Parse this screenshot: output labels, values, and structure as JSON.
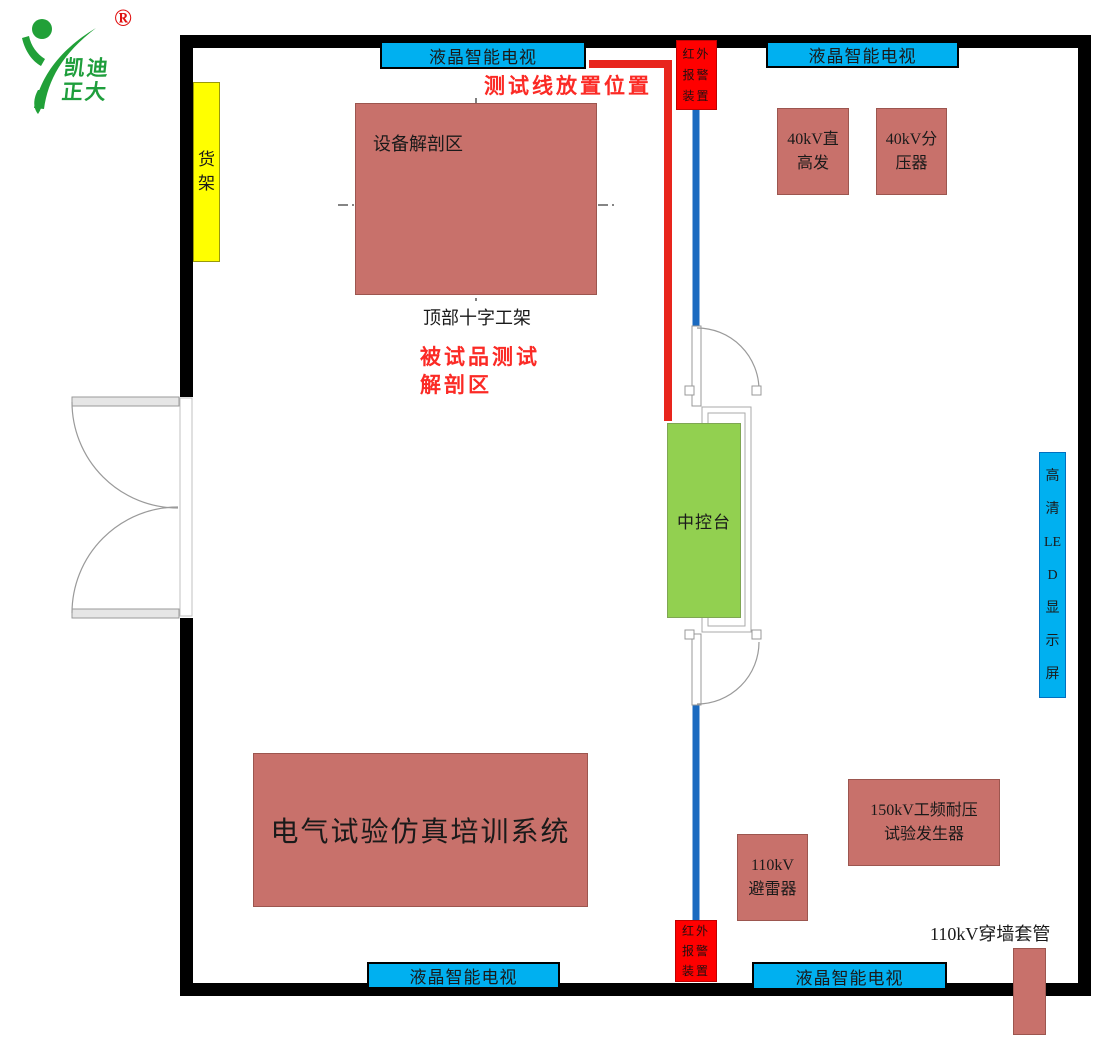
{
  "logo": {
    "line1": "凯迪",
    "line2": "正大",
    "registered": "®"
  },
  "fixtures": {
    "tv": "液晶智能电视",
    "alarm_lines": [
      "红外",
      "报警",
      "装置"
    ],
    "shelf_lines": [
      "货",
      "架"
    ],
    "led_lines": [
      "高",
      "清",
      "LE",
      "D",
      "显",
      "示",
      "屏"
    ],
    "dissection": "设备解剖区",
    "console": "中控台",
    "training": "电气试验仿真培训系统"
  },
  "equipment": {
    "gen40_lines": [
      "40kV直",
      "高发"
    ],
    "divider40_lines": [
      "40kV分",
      "压器"
    ],
    "arrester110_lines": [
      "110kV",
      "避雷器"
    ],
    "gen150_lines": [
      "150kV工频耐压",
      "试验发生器"
    ]
  },
  "annotations": {
    "test_line_position": "测试线放置位置",
    "dut_test_line1": "被试品测试",
    "dut_test_line2": "解剖区",
    "cross_frame": "顶部十字工架",
    "bushing": "110kV穿墙套管"
  },
  "colors": {
    "wall": "#000000",
    "equipment_brown": "#C8716B",
    "tv_blue": "#00B0F0",
    "console_green": "#92D050",
    "shelf_yellow": "#FFFF00",
    "alarm_red": "#FF0000",
    "cable_red": "#E8251D",
    "link_blue": "#1B6AC0",
    "logo_green": "#1E9E3C",
    "note_red": "#FB2A25"
  }
}
